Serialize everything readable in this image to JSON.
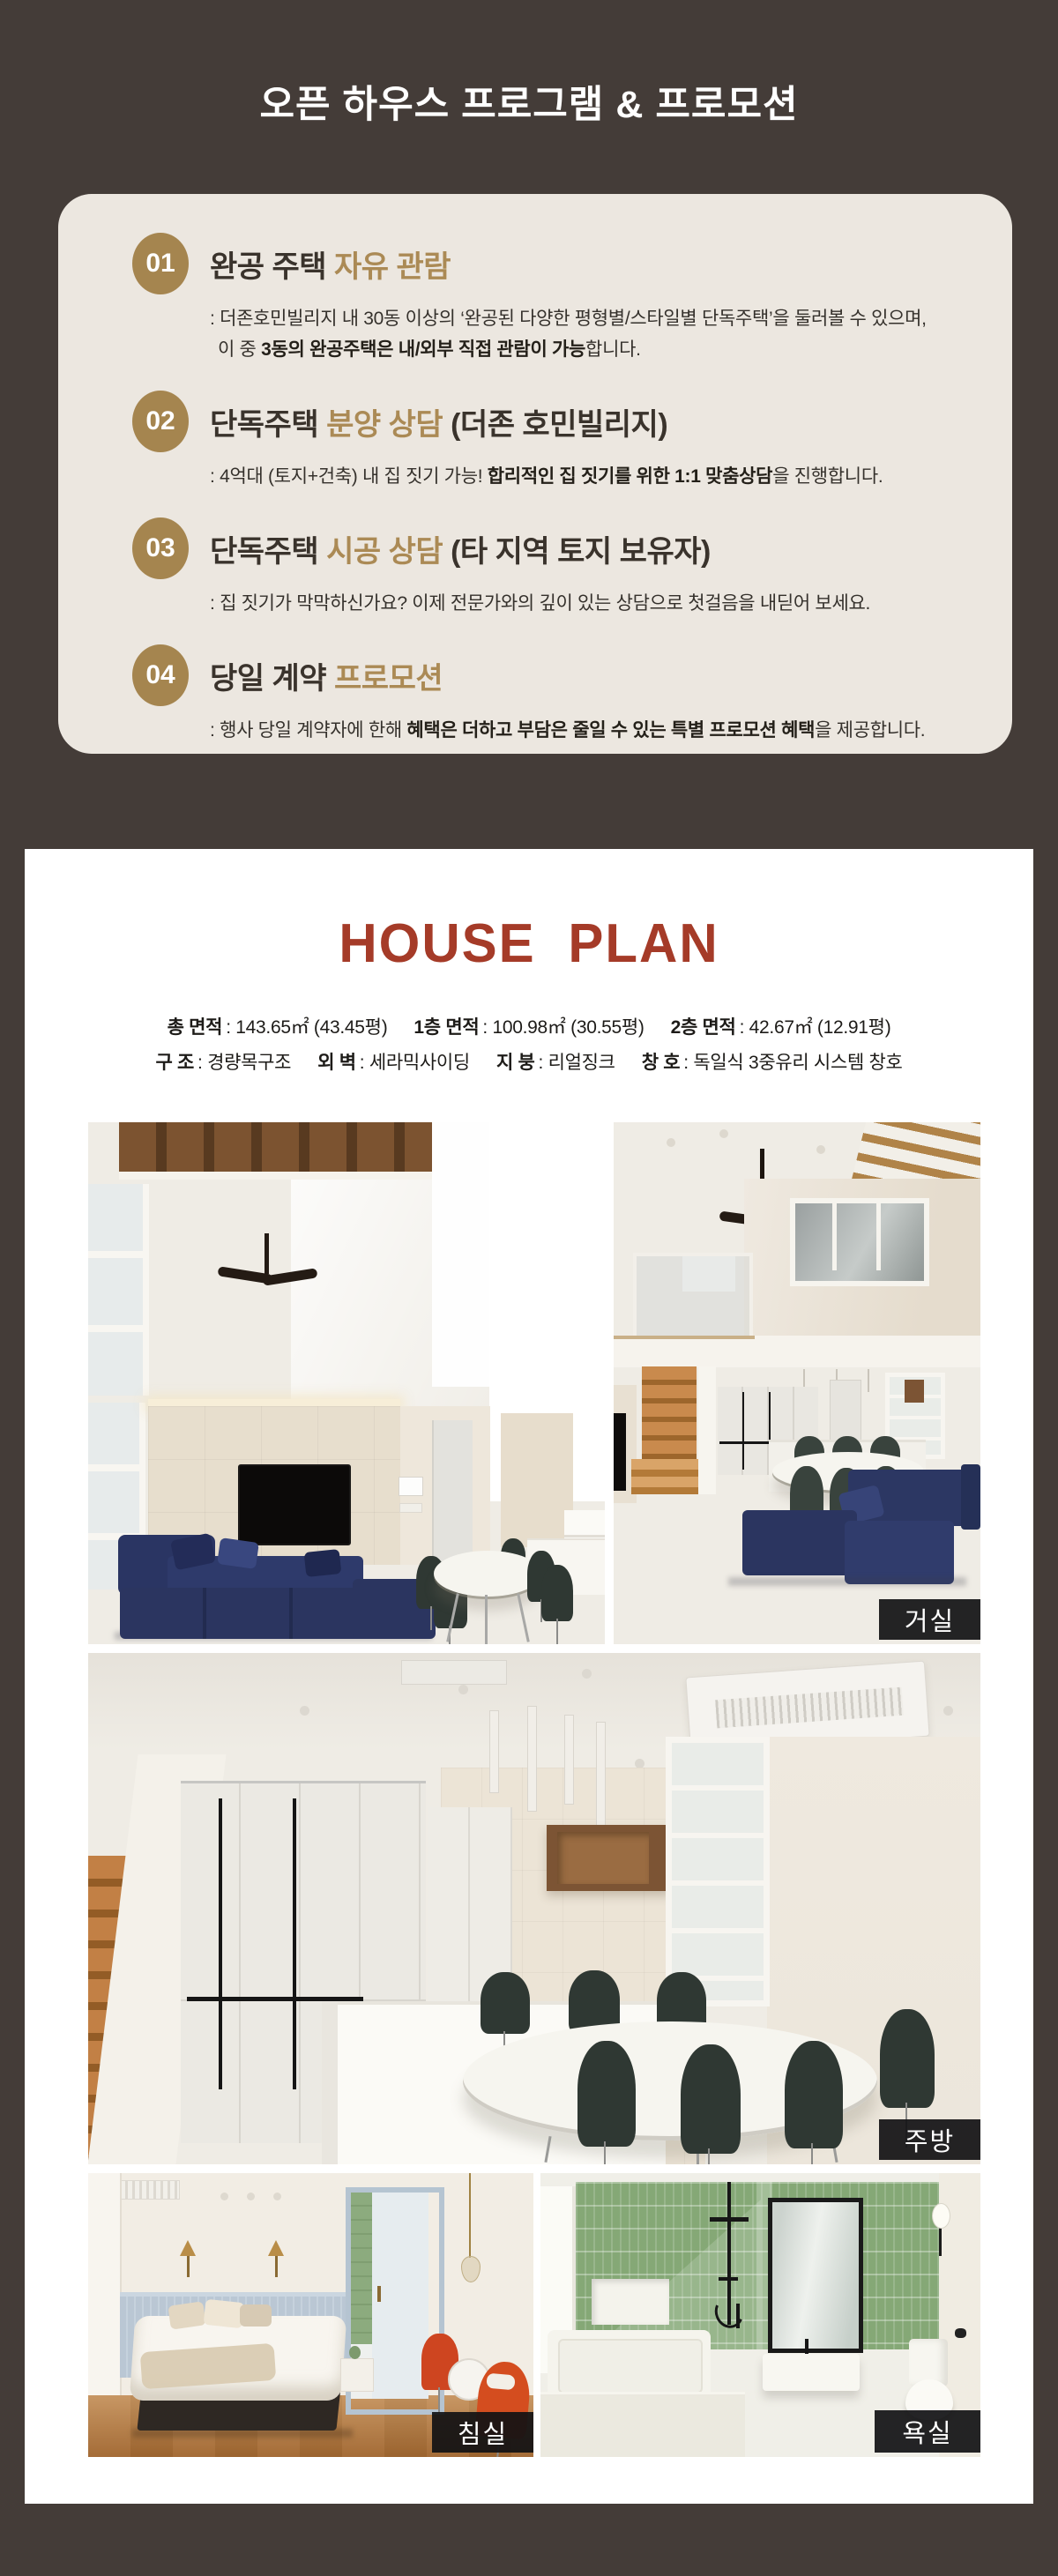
{
  "colors": {
    "background_brown": "#443c38",
    "program_card_cream": "#ece7e0",
    "accent_gold": "#ab8a55",
    "badge_gold": "#a5854f",
    "house_plan_red": "#a53b28",
    "text_dark": "#3a332c",
    "photo_label_black": "#111114"
  },
  "header": {
    "title": "오픈 하우스 프로그램 & 프로모션"
  },
  "program": {
    "items": [
      {
        "number": "01",
        "title_main": "완공 주택 ",
        "title_accent": "자유 관람",
        "title_suffix": "",
        "line1_pre": ": 더존호민빌리지 내 30동 이상의 ‘완공된 다양한 평형별/스타일별 단독주택’을 둘러볼 수 있으며,",
        "line1_bold": "",
        "line1_post": "",
        "line2_pre": "이 중 ",
        "line2_bold": "3동의 완공주택은 내/외부 직접 관람이 가능",
        "line2_post": "합니다."
      },
      {
        "number": "02",
        "title_main": "단독주택 ",
        "title_accent": "분양 상담",
        "title_suffix": " (더존 호민빌리지)",
        "line1_pre": ": 4억대 (토지+건축) 내 집 짓기 가능! ",
        "line1_bold": "합리적인 집 짓기를 위한 1:1 맞춤상담",
        "line1_post": "을 진행합니다.",
        "line2_pre": "",
        "line2_bold": "",
        "line2_post": ""
      },
      {
        "number": "03",
        "title_main": "단독주택 ",
        "title_accent": "시공 상담",
        "title_suffix": " (타 지역 토지 보유자)",
        "line1_pre": ": 집 짓기가 막막하신가요? 이제 전문가와의 깊이 있는 상담으로 첫걸음을 내딛어 보세요.",
        "line1_bold": "",
        "line1_post": "",
        "line2_pre": "",
        "line2_bold": "",
        "line2_post": ""
      },
      {
        "number": "04",
        "title_main": "당일 계약 ",
        "title_accent": "프로모션",
        "title_suffix": "",
        "line1_pre": ": 행사 당일 계약자에 한해 ",
        "line1_bold": "혜택은 더하고 부담은 줄일 수 있는 특별 프로모션 혜택",
        "line1_post": "을 제공합니다.",
        "line2_pre": "",
        "line2_bold": "",
        "line2_post": ""
      }
    ]
  },
  "house_plan": {
    "title": "HOUSE PLAN",
    "specs_row1": [
      {
        "label": "총 면적",
        "value": ": 143.65㎡ (43.45평)"
      },
      {
        "label": "1층 면적",
        "value": ": 100.98㎡ (30.55평)"
      },
      {
        "label": "2층 면적",
        "value": ": 42.67㎡ (12.91평)"
      }
    ],
    "specs_row2": [
      {
        "label": "구 조",
        "value": ": 경량목구조"
      },
      {
        "label": "외 벽",
        "value": ": 세라믹사이딩"
      },
      {
        "label": "지 붕",
        "value": ": 리얼징크"
      },
      {
        "label": "창 호",
        "value": ": 독일식 3중유리 시스템 창호"
      }
    ],
    "photo_labels": {
      "living": "거실",
      "kitchen": "주방",
      "bedroom": "침실",
      "bathroom": "욕실"
    }
  }
}
